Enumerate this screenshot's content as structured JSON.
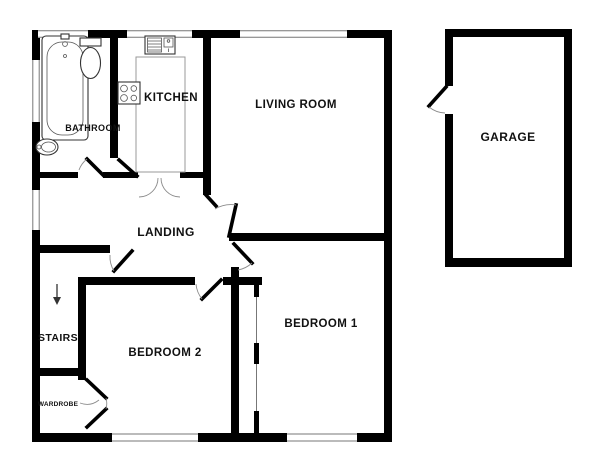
{
  "title": "Bungalow floor plan",
  "colors": {
    "wall": "#000000",
    "window_frame": "#777777",
    "door_arc": "#8c8c8c",
    "fixture_outline": "#333333",
    "worktop_outline": "#999999",
    "background": "#ffffff"
  },
  "rooms": {
    "bathroom": {
      "label": "BATHROOM"
    },
    "kitchen": {
      "label": "KITCHEN"
    },
    "living_room": {
      "label": "LIVING ROOM"
    },
    "landing": {
      "label": "LANDING"
    },
    "stairs": {
      "label": "STAIRS"
    },
    "wardrobe": {
      "label": "WARDROBE"
    },
    "bedroom1": {
      "label": "BEDROOM 1"
    },
    "bedroom2": {
      "label": "BEDROOM 2"
    },
    "garage": {
      "label": "GARAGE"
    }
  },
  "fixtures": [
    "bathtub",
    "toilet",
    "wash-basin",
    "kitchen-sink-drainer",
    "hob",
    "worktop",
    "built-in-wardrobe",
    "stairs-down-arrow"
  ],
  "doors": [
    "bathroom-door",
    "kitchen-door",
    "living-room-door",
    "bedroom-1-door",
    "bedroom-2-door",
    "stairs-door",
    "wardrobe-double-door",
    "garage-side-door"
  ],
  "windows_count": 7
}
